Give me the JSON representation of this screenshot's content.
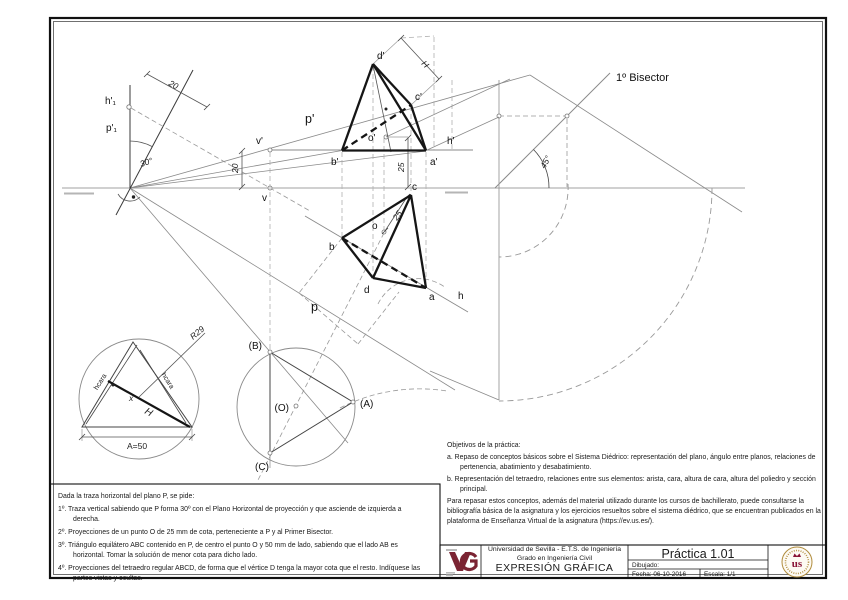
{
  "drawing": {
    "labels": {
      "h1_prime": "h'₁",
      "p1_prime": "p'₁",
      "a30": "30°",
      "d20_steep": "20",
      "d20_left": "20",
      "p_prime": "p'",
      "v_prime": "v'",
      "v": "v",
      "h_prime": "h'",
      "d_prime": "d'",
      "c_prime": "c'",
      "b_prime": "b'",
      "a_prime": "a'",
      "o_prime": "o'",
      "H_top": "H",
      "d25_elev": "25",
      "bisector": "1º Bisector",
      "a45": "45°",
      "c": "c",
      "o": "o",
      "b": "b",
      "d": "d",
      "a": "a",
      "d25_plan": "25",
      "h": "h",
      "p": "p",
      "B_ab": "(B)",
      "O_ab": "(O)",
      "A_ab": "(A)",
      "C_ab": "(C)",
      "r29": "R29",
      "H_ab": "H",
      "x_mark": "x",
      "hcara_left": "hcara",
      "hcara_right": "hcara",
      "a50": "A=50"
    }
  },
  "notes": {
    "title": "Dada la traza horizontal del plano P, se pide:",
    "items": [
      "1º. Traza vertical sabiendo que P forma 30º con el Plano Horizontal de proyección y que asciende de izquierda a derecha.",
      "2º. Proyecciones de un punto O de 25 mm de cota, perteneciente a P y al Primer Bisector.",
      "3º. Triángulo equilátero ABC contenido en P, de centro el punto O y 50 mm de lado, sabiendo que el lado AB es horizontal. Tomar la solución de menor cota para dicho lado.",
      "4º. Proyecciones del tetraedro regular ABCD, de forma que el vértice D tenga la mayor cota que el resto. Indíquese las partes vistas y ocultas."
    ]
  },
  "objectives": {
    "title": "Objetivos de la práctica:",
    "items": [
      "a. Repaso de conceptos básicos sobre el Sistema Diédrico: representación del plano, ángulo entre planos, relaciones de pertenencia, abatimiento y desabatimiento.",
      "b. Representación del tetraedro, relaciones entre sus elementos: arista, cara, altura de cara, altura del poliedro y sección principal."
    ],
    "footer": "Para repasar estos conceptos, además del material utilizado durante los cursos de bachillerato, puede consultarse la bibliografía básica de la asignatura y los ejercicios resueltos sobre el sistema diédrico, que se encuentran publicados en la plataforma de Enseñanza Virtual de la asignatura (https://ev.us.es/)."
  },
  "titleblock": {
    "university": "Universidad de Sevilla - E.T.S. de Ingeniería",
    "degree": "Grado en Ingeniería Civil",
    "course": "EXPRESIÓN GRÁFICA",
    "practice": "Práctica 1.01",
    "drawn_label": "Dibujado:",
    "date": "Fecha: 06-10-2016",
    "scale": "Escala: 1/1",
    "accent_color": "#7b2433",
    "seal_color": "#b08c3c"
  }
}
